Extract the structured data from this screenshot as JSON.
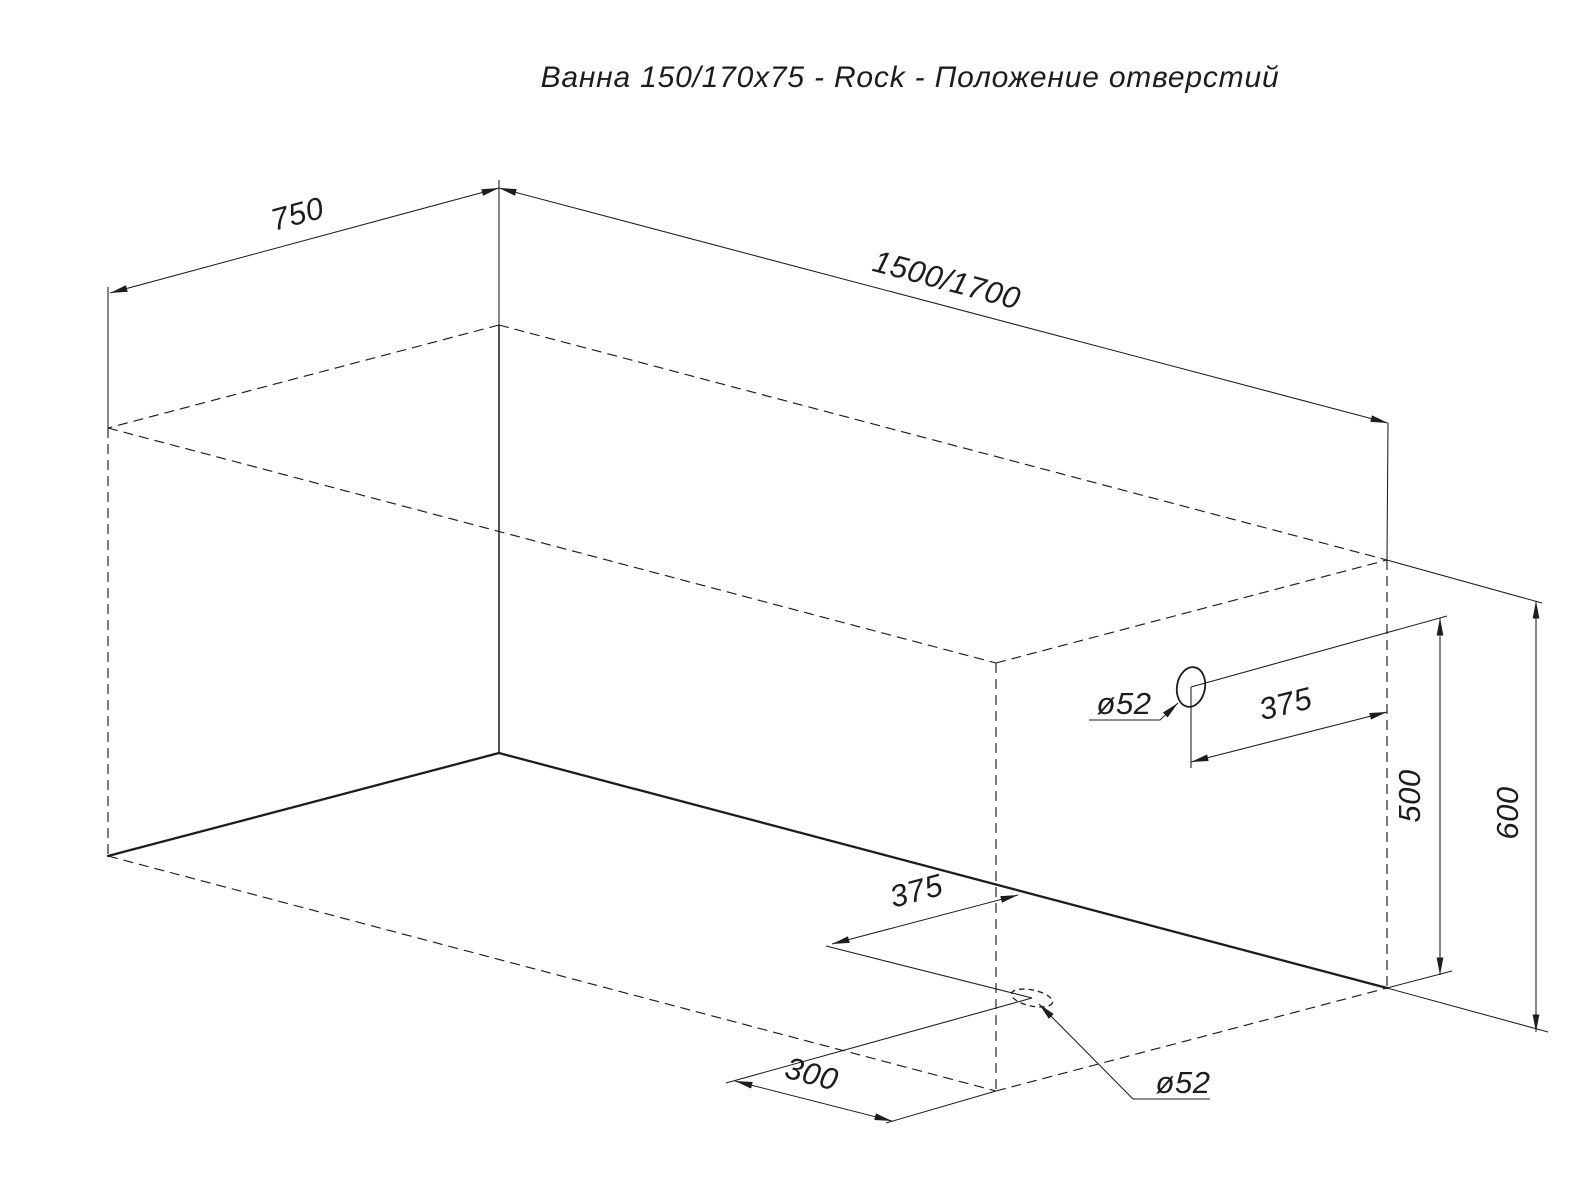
{
  "title": "Ванна 150/170x75 - Rock - Положение отверстий",
  "drawing": {
    "kind": "isometric-technical-drawing",
    "object": "bathtub-outline-with-hole-positions",
    "colors": {
      "line": "#1d1d1d",
      "background": "#ffffff"
    },
    "labels": {
      "width": "750",
      "length": "1500/1700",
      "overflow_to_end": "375",
      "overflow_height": "500",
      "height": "600",
      "drain_to_front_edge": "375",
      "drain_to_back_corner": "300",
      "overflow_diameter": "ø52",
      "drain_diameter": "ø52"
    }
  }
}
